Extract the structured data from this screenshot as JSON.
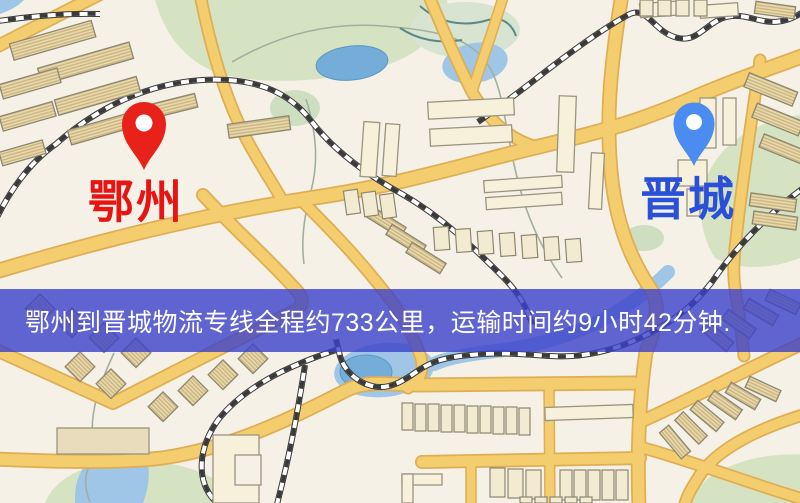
{
  "map": {
    "origin_marker": {
      "label": "鄂州",
      "pin_color": "#e8211a",
      "label_color": "#e81414"
    },
    "destination_marker": {
      "label": "晋城",
      "pin_color": "#4a8cf0",
      "label_color": "#2a50d8"
    },
    "banner": {
      "text": "鄂州到晋城物流专线全程约733公里，运输时间约9小时42分钟.",
      "overlay_color": "#3b41cb",
      "text_color": "#ffffff"
    }
  },
  "colors": {
    "map-bg": "#f6f1e6",
    "road-fill": "#f3cd6e",
    "road-casing": "#dfae54",
    "building-plain": "#f7f0da",
    "building-hatch": "#ecdcae",
    "building-outline": "#8d8671",
    "park-green": "#d5e3c3",
    "water-blue": "#9fc6e6",
    "pond-blue": "#74add8",
    "railway-dark": "#3a3a3a",
    "origin-text": "#e81414",
    "destination-text": "#2a50d8",
    "banner-overlay": "#3b41cb",
    "banner-text": "#ffffff"
  }
}
